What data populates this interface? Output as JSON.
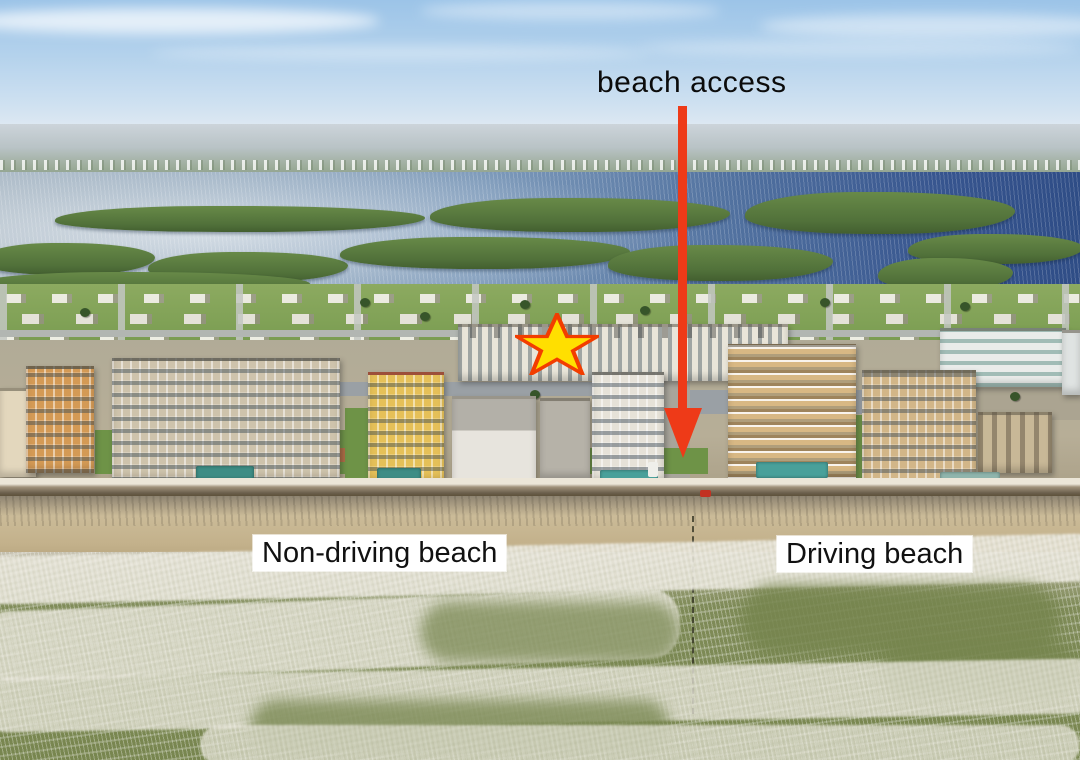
{
  "annotations": {
    "beach_access": {
      "label": "beach access",
      "arrow_color": "#ee3a18"
    },
    "star_marker": {
      "fill": "#ffdf00",
      "outline": "#f23d00"
    },
    "beach_labels": {
      "non_driving": "Non-driving beach",
      "driving": "Driving beach",
      "background": "#ffffff",
      "text_color": "#111111"
    }
  }
}
